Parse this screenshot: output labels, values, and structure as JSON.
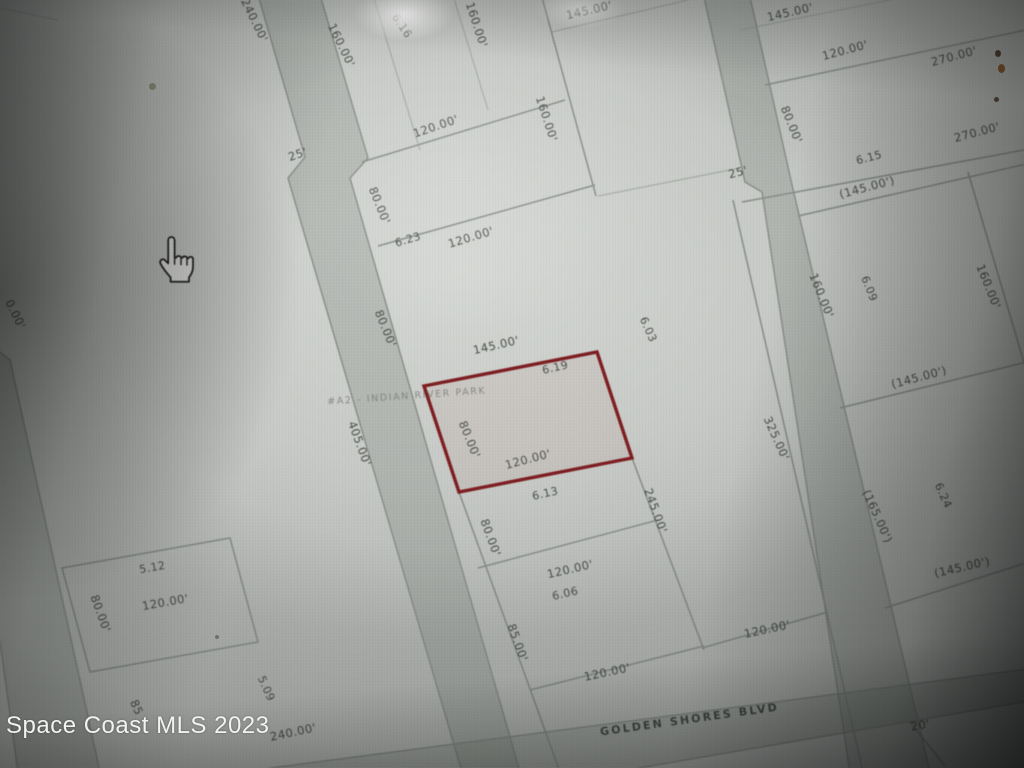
{
  "watermark": {
    "text": "Space Coast MLS 2023"
  },
  "map": {
    "street_name": "GOLDEN SHORES BLVD",
    "subdivision_note": "#A2 - INDIAN RIVER PARK",
    "subject_parcel": {
      "number": "6.19",
      "front_dimension": "145.00'",
      "side_dimension": "80.00'",
      "rear_dimension": "120.00'",
      "outline_color": "#7d1d20"
    },
    "parcel_numbers": [
      "6.16",
      "6.23",
      "6.19",
      "6.13",
      "6.06",
      "6.03",
      "6.15",
      "6.09",
      "6.24",
      "5.12",
      "5.09"
    ],
    "labels": [
      {
        "t": "240.00'",
        "x": 251,
        "y": 22,
        "r": 64,
        "c": "dim"
      },
      {
        "t": "160.00'",
        "x": 338,
        "y": 47,
        "r": 64,
        "c": "dim"
      },
      {
        "t": "6.16",
        "x": 399,
        "y": 28,
        "r": 56,
        "c": "parcel"
      },
      {
        "t": "160.00'",
        "x": 473,
        "y": 26,
        "r": 72,
        "c": "dim"
      },
      {
        "t": "145.00'",
        "x": 590,
        "y": 14,
        "r": -13,
        "c": "dim"
      },
      {
        "t": "160.00'",
        "x": 543,
        "y": 120,
        "r": 72,
        "c": "dim"
      },
      {
        "t": "120.00'",
        "x": 437,
        "y": 130,
        "r": -19,
        "c": "dim"
      },
      {
        "t": "25'",
        "x": 299,
        "y": 158,
        "r": -19,
        "c": "dim"
      },
      {
        "t": "80.00'",
        "x": 376,
        "y": 207,
        "r": 68,
        "c": "dim"
      },
      {
        "t": "6.23",
        "x": 409,
        "y": 243,
        "r": -17,
        "c": "parcel"
      },
      {
        "t": "120.00'",
        "x": 472,
        "y": 241,
        "r": -17,
        "c": "dim"
      },
      {
        "t": "145.00'",
        "x": 791,
        "y": 16,
        "r": -13,
        "c": "dim"
      },
      {
        "t": "120.00'",
        "x": 846,
        "y": 54,
        "r": -15,
        "c": "dim"
      },
      {
        "t": "270.00'",
        "x": 955,
        "y": 60,
        "r": -15,
        "c": "dim"
      },
      {
        "t": "270.00'",
        "x": 978,
        "y": 136,
        "r": -15,
        "c": "dim"
      },
      {
        "t": "80.00'",
        "x": 788,
        "y": 126,
        "r": 68,
        "c": "dim"
      },
      {
        "t": "6.15",
        "x": 870,
        "y": 161,
        "r": -15,
        "c": "parcel"
      },
      {
        "t": "(145.00')",
        "x": 868,
        "y": 191,
        "r": -15,
        "c": "dim"
      },
      {
        "t": "25'",
        "x": 739,
        "y": 176,
        "r": -15,
        "c": "dim"
      },
      {
        "t": "160.00'",
        "x": 818,
        "y": 297,
        "r": 68,
        "c": "dim"
      },
      {
        "t": "6.09",
        "x": 866,
        "y": 290,
        "r": 68,
        "c": "parcel"
      },
      {
        "t": "160.00'",
        "x": 985,
        "y": 288,
        "r": 68,
        "c": "dim"
      },
      {
        "t": "(145.00')",
        "x": 920,
        "y": 381,
        "r": -15,
        "c": "dim"
      },
      {
        "t": "80.00'",
        "x": 382,
        "y": 330,
        "r": 68,
        "c": "dim"
      },
      {
        "t": "145.00'",
        "x": 497,
        "y": 349,
        "r": -13,
        "c": "dim"
      },
      {
        "t": "6.19",
        "x": 556,
        "y": 371,
        "r": -13,
        "c": "parcel"
      },
      {
        "t": "#A2 - INDIAN RIVER PARK",
        "x": 407,
        "y": 399,
        "r": -4,
        "c": "note"
      },
      {
        "t": "80.00'",
        "x": 466,
        "y": 441,
        "r": 68,
        "c": "dim"
      },
      {
        "t": "120.00'",
        "x": 529,
        "y": 463,
        "r": -15,
        "c": "dim"
      },
      {
        "t": "405.00'",
        "x": 356,
        "y": 445,
        "r": 70,
        "c": "dim"
      },
      {
        "t": "6.03",
        "x": 645,
        "y": 331,
        "r": 66,
        "c": "parcel"
      },
      {
        "t": "325.00'",
        "x": 773,
        "y": 440,
        "r": 66,
        "c": "dim"
      },
      {
        "t": "245.00'",
        "x": 652,
        "y": 512,
        "r": 70,
        "c": "dim"
      },
      {
        "t": "6.13",
        "x": 546,
        "y": 497,
        "r": -13,
        "c": "parcel"
      },
      {
        "t": "80.00'",
        "x": 487,
        "y": 539,
        "r": 70,
        "c": "dim"
      },
      {
        "t": "120.00'",
        "x": 571,
        "y": 573,
        "r": -13,
        "c": "dim"
      },
      {
        "t": "6.06",
        "x": 566,
        "y": 597,
        "r": -13,
        "c": "parcel"
      },
      {
        "t": "85.00'",
        "x": 514,
        "y": 644,
        "r": 70,
        "c": "dim"
      },
      {
        "t": "120.00'",
        "x": 608,
        "y": 676,
        "r": -12,
        "c": "dim"
      },
      {
        "t": "(165.00')",
        "x": 874,
        "y": 518,
        "r": 66,
        "c": "dim"
      },
      {
        "t": "6.24",
        "x": 940,
        "y": 497,
        "r": 66,
        "c": "parcel"
      },
      {
        "t": "(145.00')",
        "x": 963,
        "y": 571,
        "r": -13,
        "c": "dim"
      },
      {
        "t": "120.00'",
        "x": 768,
        "y": 633,
        "r": -12,
        "c": "dim"
      },
      {
        "t": "5.12",
        "x": 153,
        "y": 571,
        "r": -10,
        "c": "parcel"
      },
      {
        "t": "80.00'",
        "x": 97,
        "y": 615,
        "r": 70,
        "c": "dim"
      },
      {
        "t": "120.00'",
        "x": 166,
        "y": 606,
        "r": -10,
        "c": "dim"
      },
      {
        "t": "85",
        "x": 133,
        "y": 709,
        "r": 66,
        "c": "dim"
      },
      {
        "t": "5.09",
        "x": 263,
        "y": 690,
        "r": 66,
        "c": "parcel"
      },
      {
        "t": "240.00'",
        "x": 294,
        "y": 736,
        "r": -12,
        "c": "dim"
      },
      {
        "t": "GOLDEN SHORES BLVD",
        "x": 690,
        "y": 723,
        "r": -8,
        "c": "street"
      },
      {
        "t": "20'",
        "x": 921,
        "y": 729,
        "r": -10,
        "c": "dim"
      },
      {
        "t": "0.00'",
        "x": 12,
        "y": 316,
        "r": 64,
        "c": "dim"
      }
    ]
  },
  "cursor": {
    "icon": "hand-pointer"
  },
  "colors": {
    "map_background": "#c7cac6",
    "boundary_line": "#868c87",
    "subject_outline": "#7d1d20",
    "label_text": "#40453f",
    "watermark_text": "#f2f2ef"
  }
}
